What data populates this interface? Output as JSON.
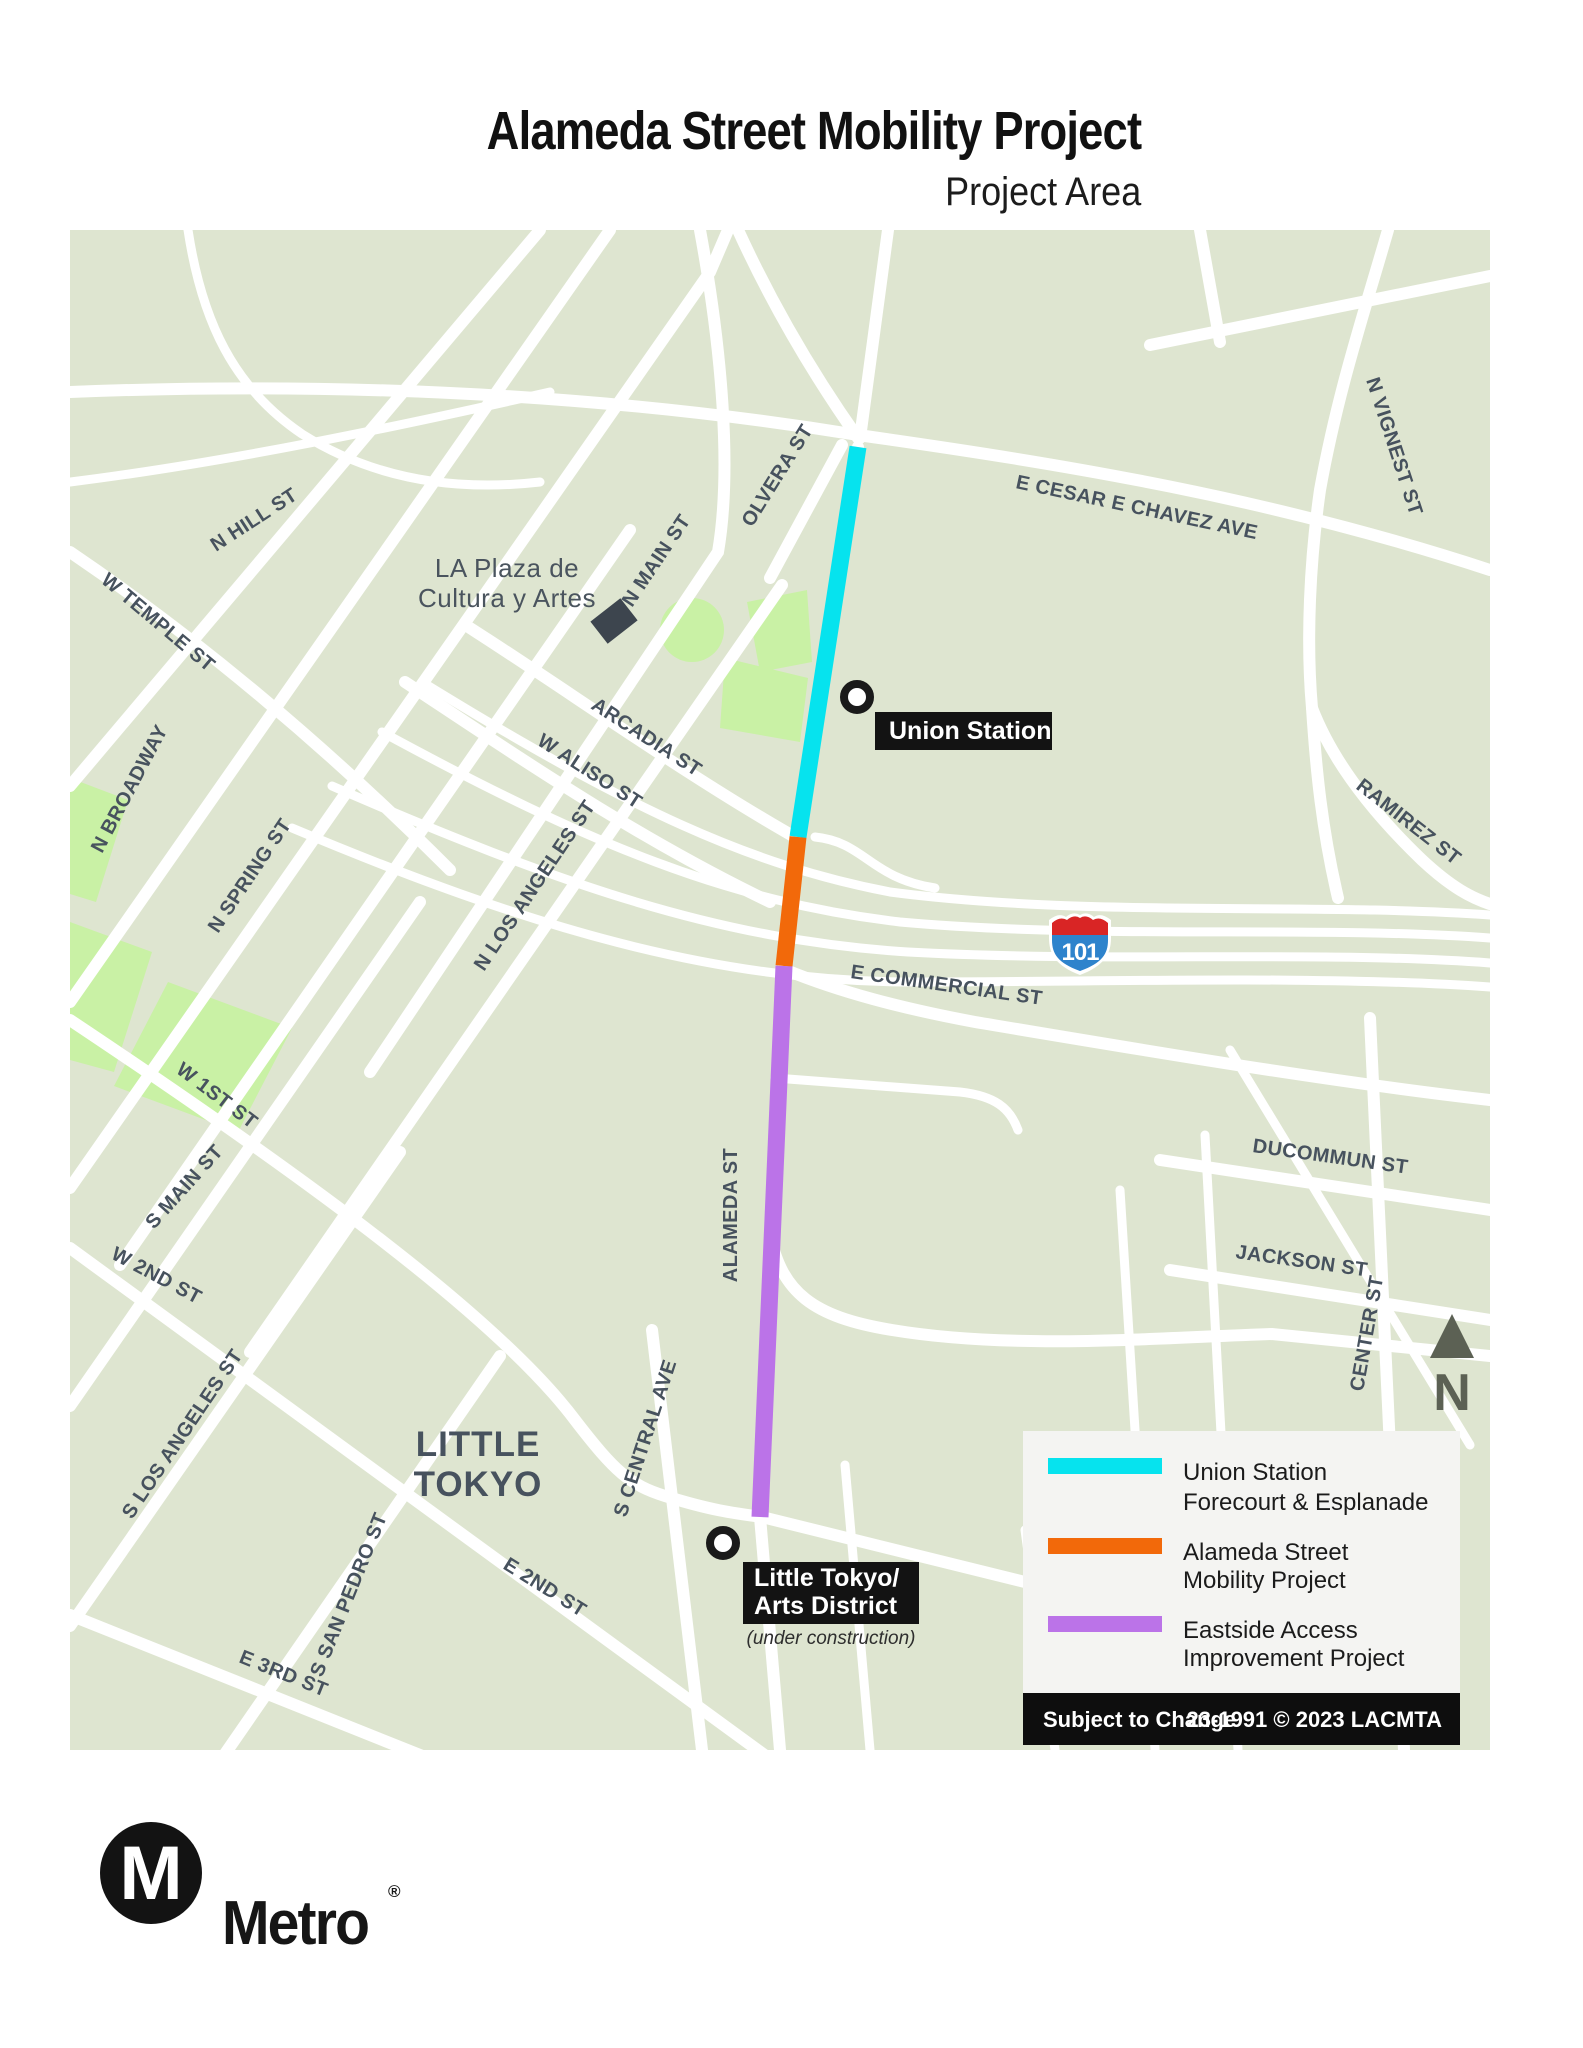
{
  "header": {
    "title": "Alameda Street Mobility Project",
    "subtitle": "Project Area"
  },
  "map": {
    "streets": {
      "n_hill": "N HILL ST",
      "w_temple": "W TEMPLE ST",
      "n_broadway": "N BROADWAY",
      "n_spring": "N SPRING ST",
      "n_los_angeles": "N LOS ANGELES ST",
      "w_1st": "W 1ST ST",
      "s_main": "S MAIN ST",
      "w_2nd": "W 2ND ST",
      "s_los_angeles": "S LOS ANGELES ST",
      "s_san_pedro": "S SAN PEDRO ST",
      "e_2nd": "E 2ND ST",
      "e_3rd": "E 3RD ST",
      "s_central": "S CENTRAL AVE",
      "alameda": "ALAMEDA ST",
      "e_commercial": "E COMMERCIAL ST",
      "ducommun": "DUCOMMUN ST",
      "jackson": "JACKSON ST",
      "center": "CENTER ST",
      "ramirez": "RAMIREZ ST",
      "n_vignest": "N VIGNEST ST",
      "olvera": "OLVERA ST",
      "n_main": "N MAIN ST",
      "arcadia": "ARCADIA ST",
      "w_aliso": "W ALISO ST",
      "e_cesar_chavez": "E CESAR E CHAVEZ AVE"
    },
    "areas": {
      "la_plaza_1": "LA Plaza de",
      "la_plaza_2": "Cultura y Artes",
      "little_tokyo_1": "LITTLE",
      "little_tokyo_2": "TOKYO"
    },
    "stations": {
      "union": "Union Station",
      "little_tokyo_1": "Little Tokyo/",
      "little_tokyo_2": "Arts District",
      "little_tokyo_note": "(under construction)"
    },
    "highway": {
      "number": "101"
    },
    "north": "N",
    "colors": {
      "background": "#dee5d0",
      "park": "#c9f1a5",
      "street": "#ffffff",
      "label": "#47525e",
      "shield_red": "#d92525",
      "shield_blue": "#2e83cc"
    }
  },
  "legend": {
    "items": [
      {
        "color": "#06e3ee",
        "label_1": "Union Station",
        "label_2": "Forecourt & Esplanade"
      },
      {
        "color": "#f2690a",
        "label_1": "Alameda Street",
        "label_2": "Mobility Project"
      },
      {
        "color": "#bb73e8",
        "label_1": "Eastside Access",
        "label_2": "Improvement Project"
      }
    ],
    "bar": {
      "left": "Subject to Change",
      "right": "23-1991 © 2023 LACMTA"
    }
  },
  "brand": {
    "m": "M",
    "name": "Metro",
    "reg": "®"
  }
}
